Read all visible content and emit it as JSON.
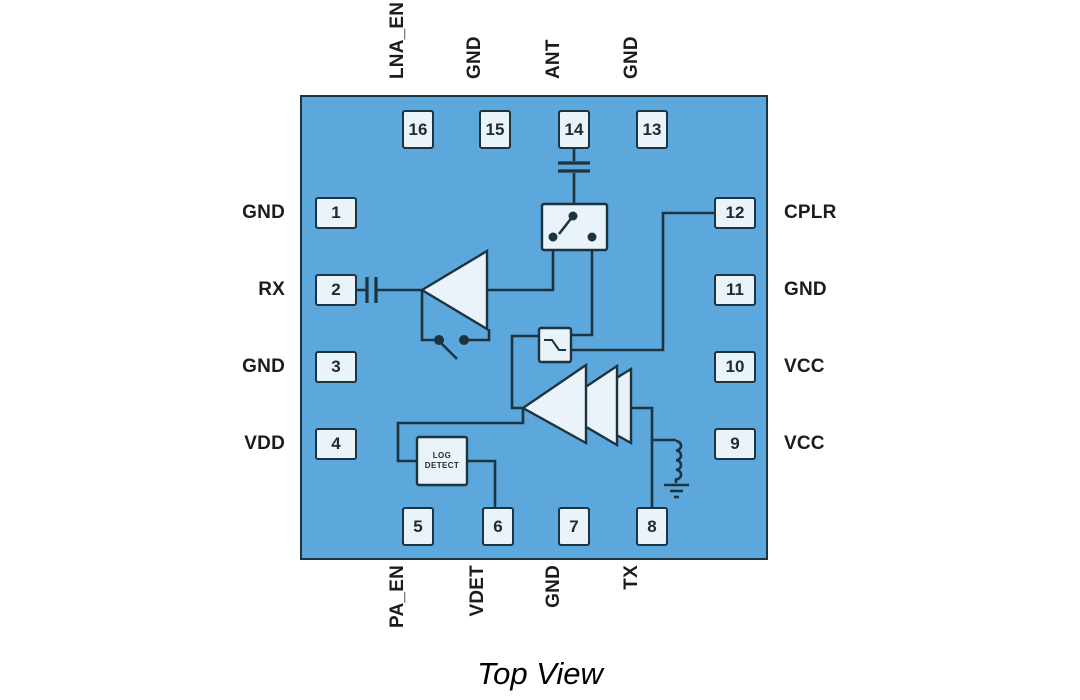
{
  "title": "Top View",
  "colors": {
    "chip_body": "#5CA7DB",
    "component_fill": "#EAF2FA",
    "line": "#1B3440",
    "label_text": "#1C1C1E"
  },
  "chip": {
    "pins": {
      "top": [
        {
          "number": "16",
          "label": "LNA_EN"
        },
        {
          "number": "15",
          "label": "GND"
        },
        {
          "number": "14",
          "label": "ANT"
        },
        {
          "number": "13",
          "label": "GND"
        }
      ],
      "left": [
        {
          "number": "1",
          "label": "GND"
        },
        {
          "number": "2",
          "label": "RX"
        },
        {
          "number": "3",
          "label": "GND"
        },
        {
          "number": "4",
          "label": "VDD"
        }
      ],
      "right": [
        {
          "number": "12",
          "label": "CPLR"
        },
        {
          "number": "11",
          "label": "GND"
        },
        {
          "number": "10",
          "label": "VCC"
        },
        {
          "number": "9",
          "label": "VCC"
        }
      ],
      "bottom": [
        {
          "number": "5",
          "label": "PA_EN"
        },
        {
          "number": "6",
          "label": "VDET"
        },
        {
          "number": "7",
          "label": "GND"
        },
        {
          "number": "8",
          "label": "TX"
        }
      ]
    },
    "blocks": {
      "log_detect_line1": "LOG",
      "log_detect_line2": "DETECT"
    }
  }
}
